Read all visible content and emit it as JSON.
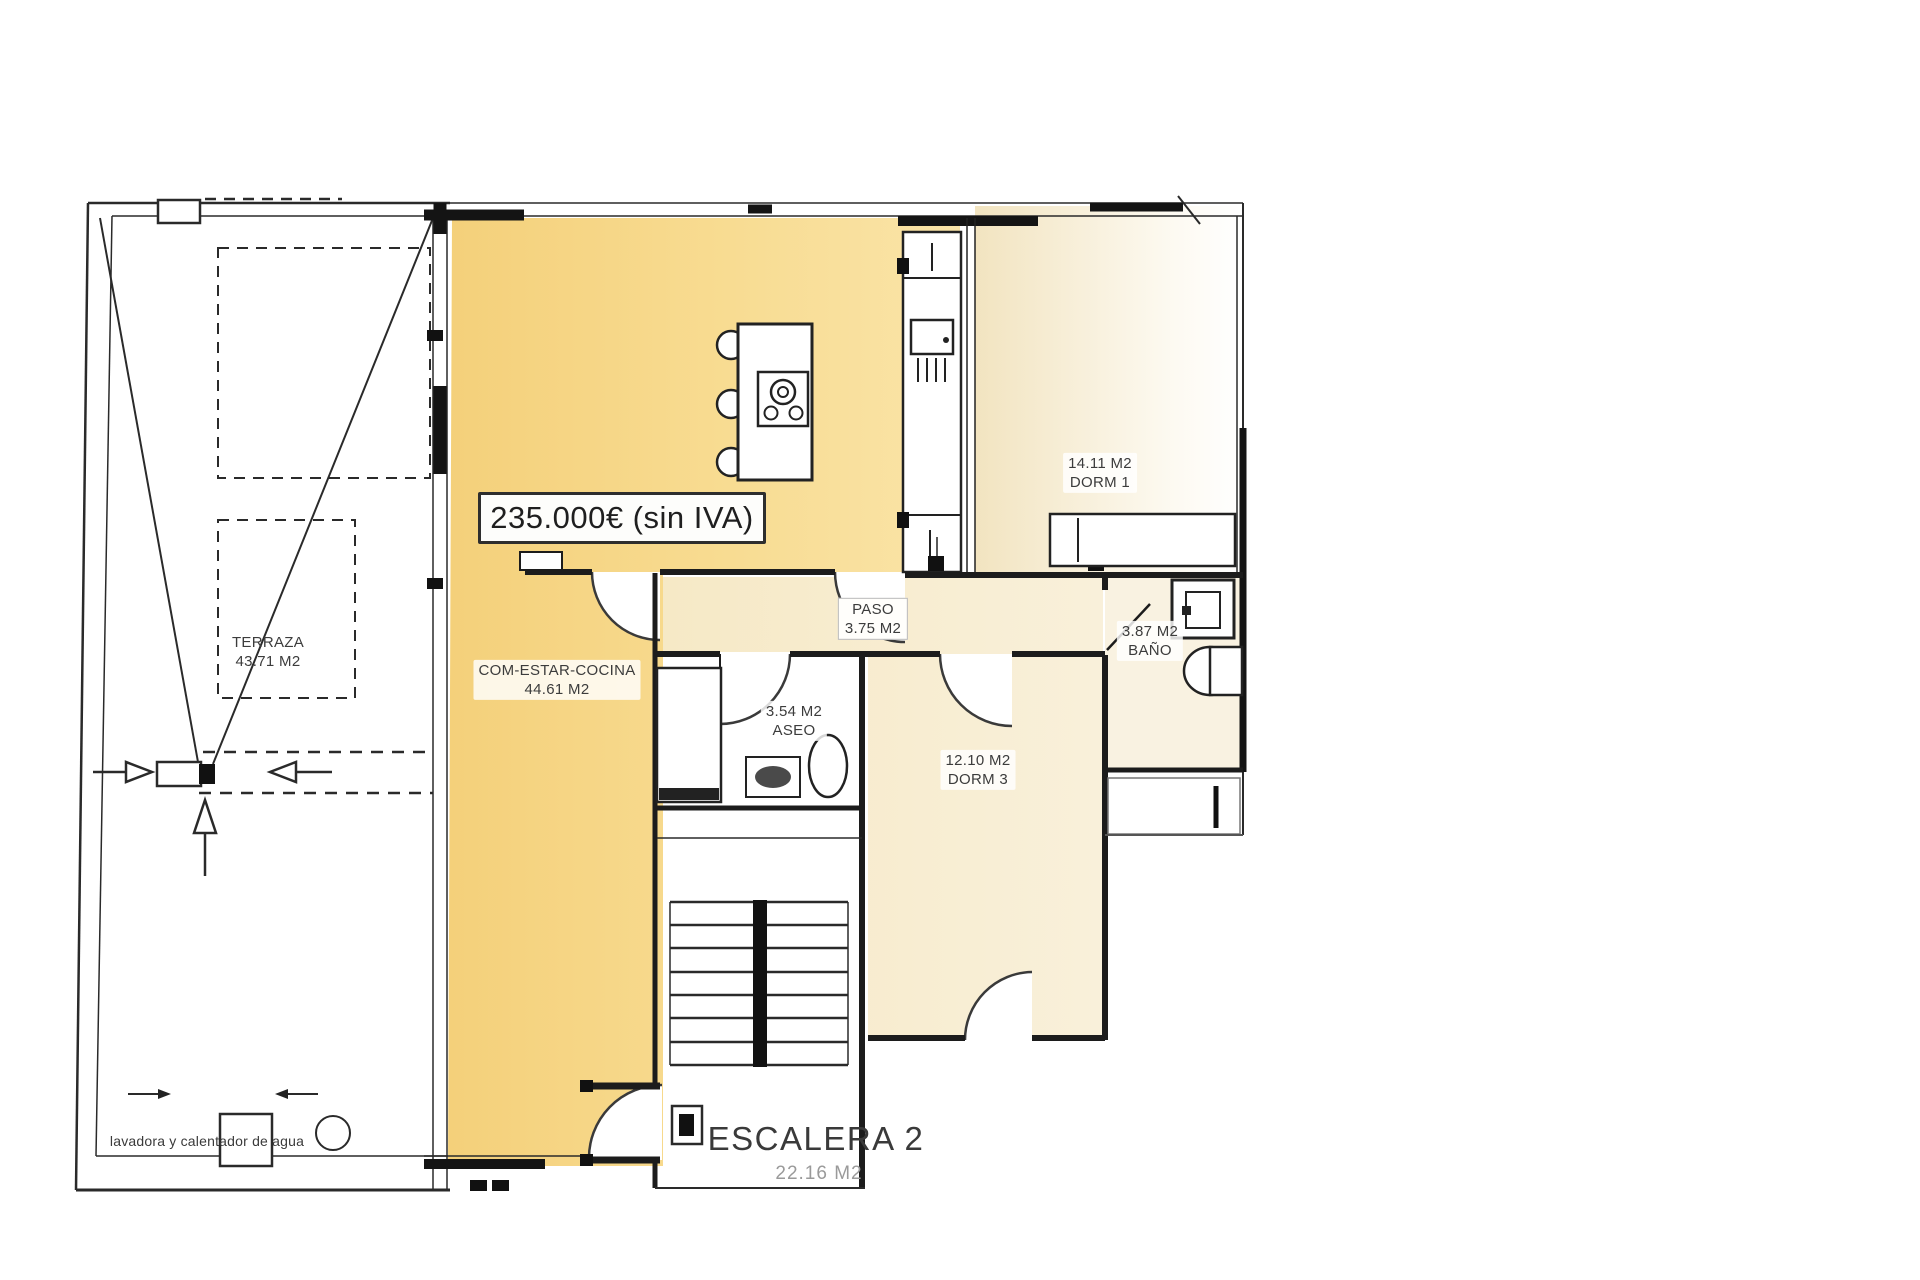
{
  "price_tag": {
    "text": "235.000€ (sin IVA)"
  },
  "rooms": {
    "terraza": {
      "name": "TERRAZA",
      "area": "43.71 M2"
    },
    "living_kitchen": {
      "name": "COM-ESTAR-COCINA",
      "area": "44.61 M2"
    },
    "paso": {
      "name": "PASO",
      "area": "3.75 M2"
    },
    "aseo": {
      "name": "ASEO",
      "area": "3.54 M2"
    },
    "dorm1": {
      "name": "DORM 1",
      "area": "14.11 M2"
    },
    "dorm3": {
      "name": "DORM 3",
      "area": "12.10 M2"
    },
    "bano": {
      "name": "BAÑO",
      "area": "3.87 M2"
    },
    "escalera": {
      "name": "ESCALERA 2",
      "area": "22.16 M2"
    }
  },
  "annotations": {
    "laundry_note": "lavadora y calentador de agua"
  },
  "colors": {
    "highlight_yellow": "#f5d27e",
    "pale_cream": "#f6ecce",
    "wall_black": "#1c1c1c"
  }
}
